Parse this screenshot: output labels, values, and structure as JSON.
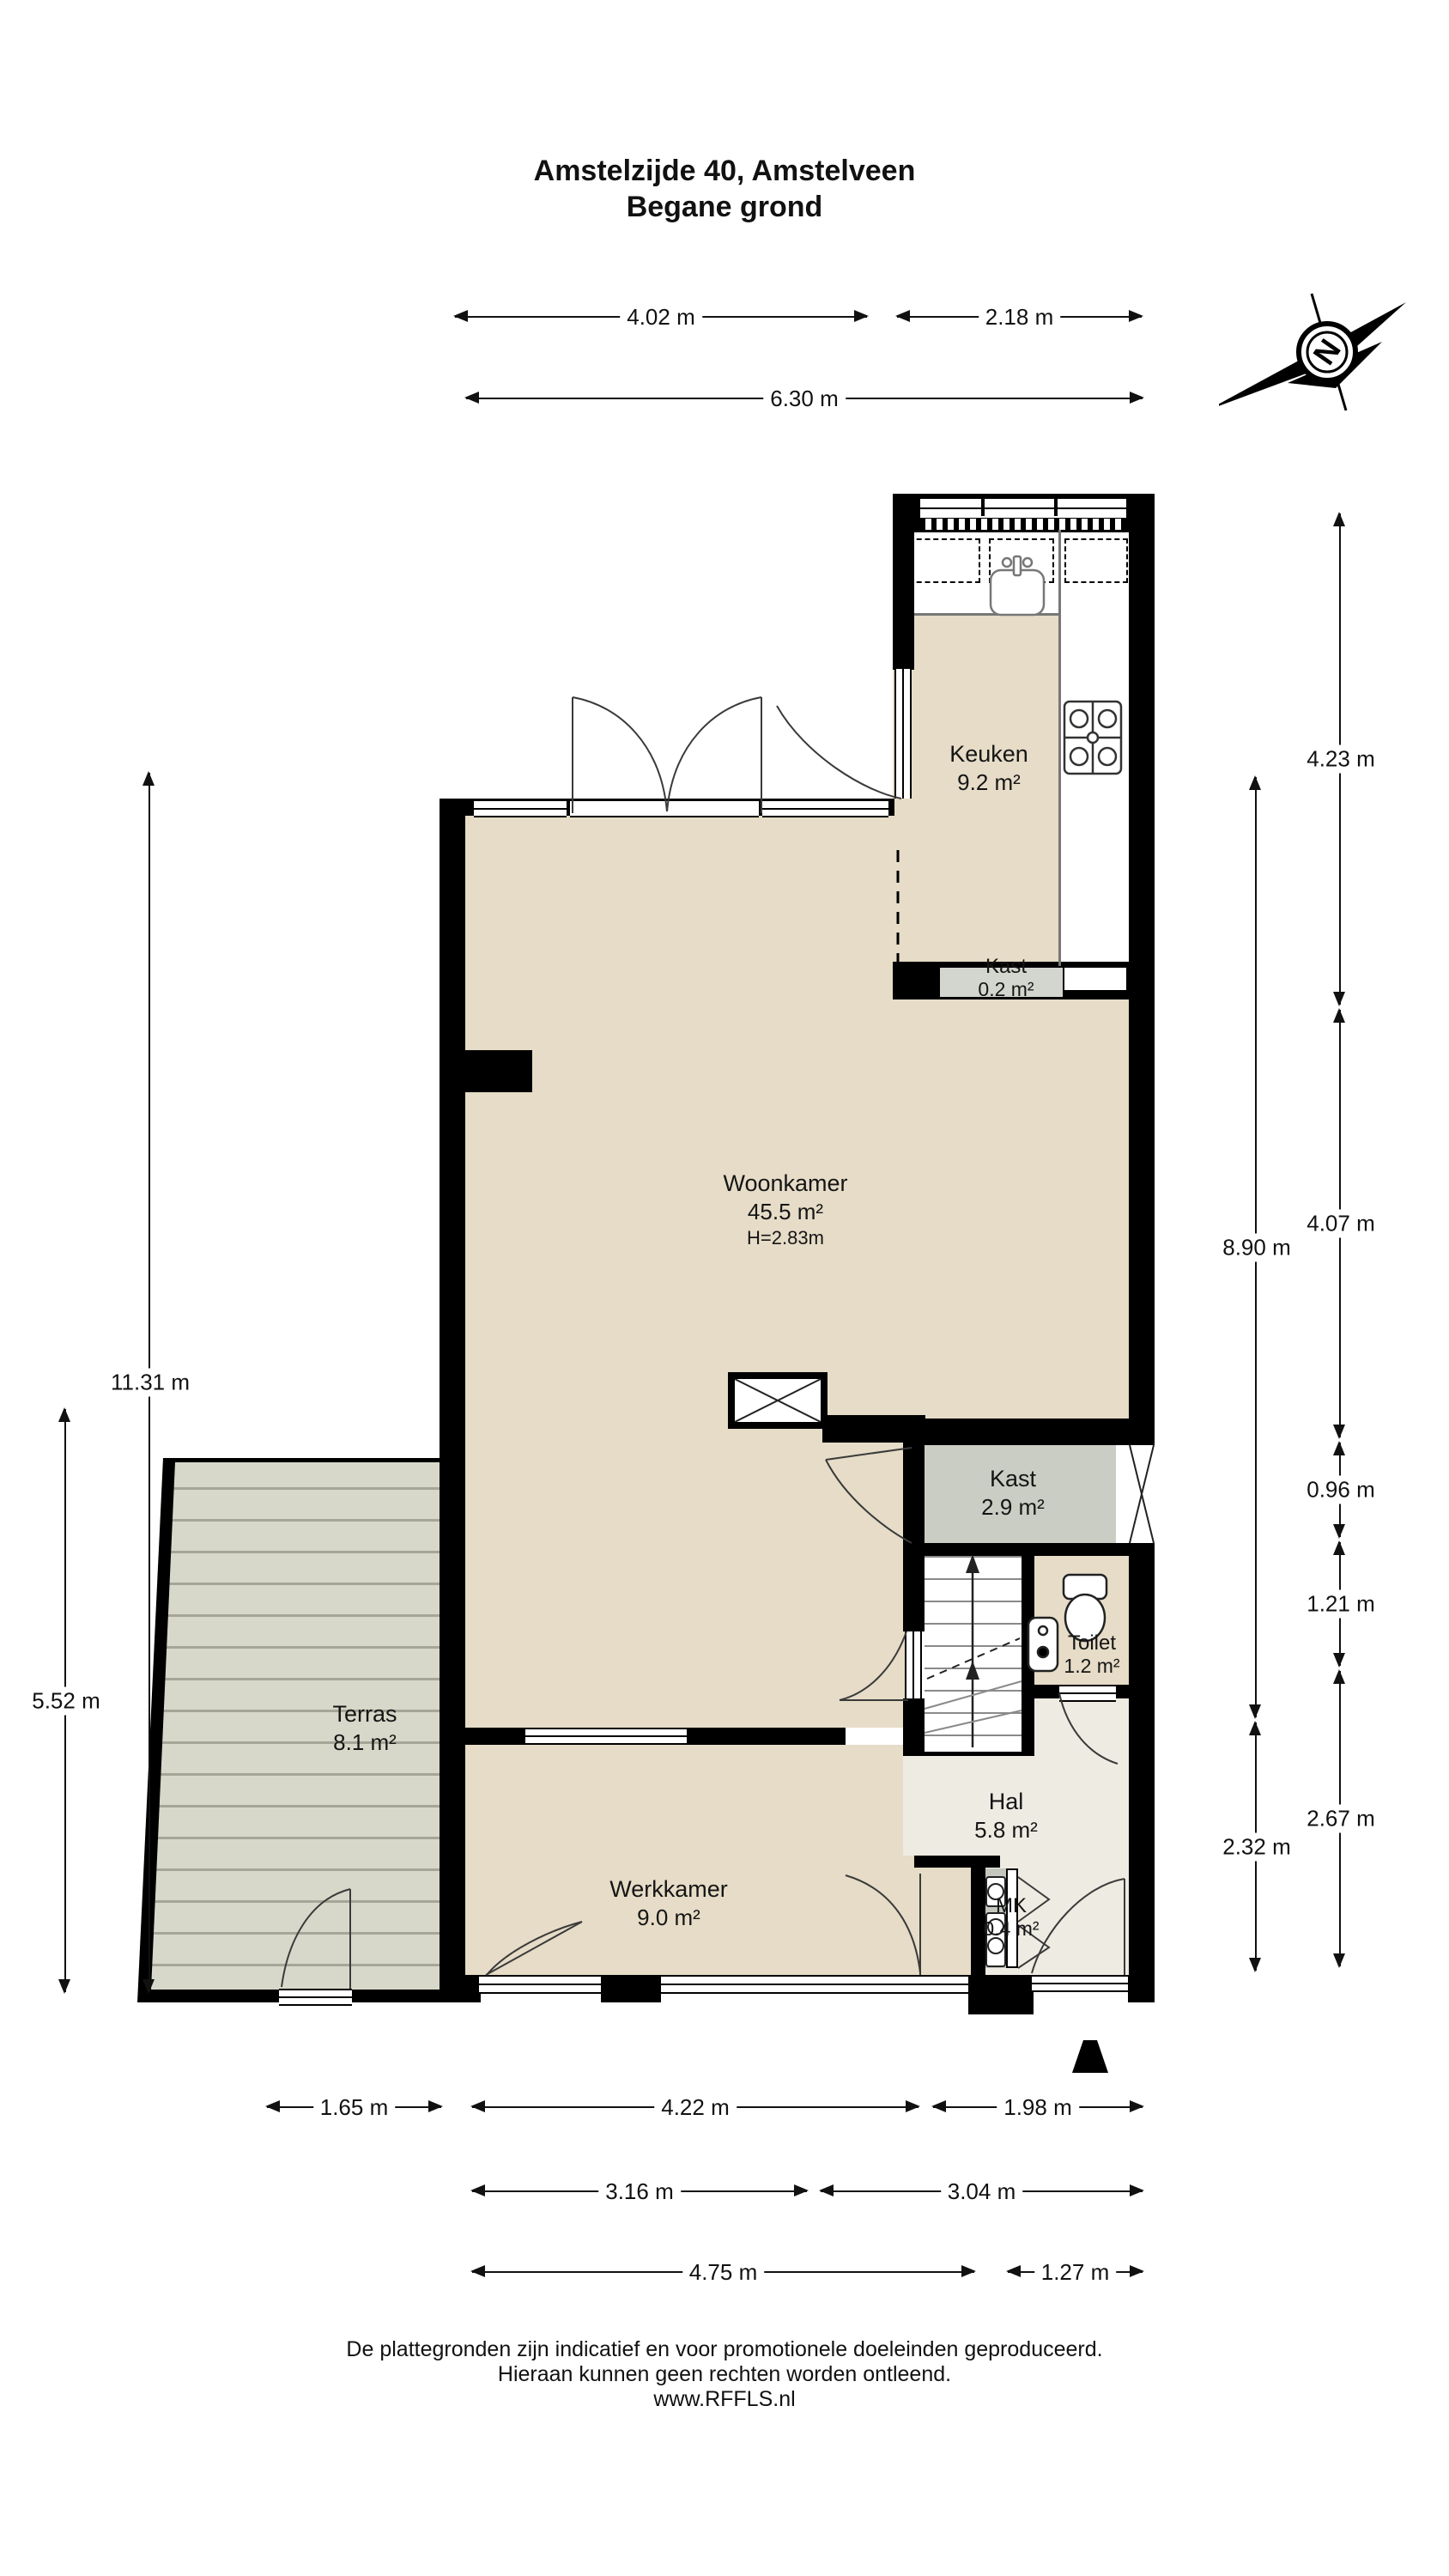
{
  "title": {
    "line1": "Amstelzijde 40, Amstelveen",
    "line2": "Begane grond"
  },
  "compass": {
    "letter": "N"
  },
  "rooms": {
    "keuken": {
      "name": "Keuken",
      "area": "9.2 m²"
    },
    "kast_klein": {
      "name": "Kast",
      "area": "0.2 m²"
    },
    "woonkamer": {
      "name": "Woonkamer",
      "area": "45.5 m²",
      "height": "H=2.83m"
    },
    "kast": {
      "name": "Kast",
      "area": "2.9 m²"
    },
    "toilet": {
      "name": "Toilet",
      "area": "1.2 m²"
    },
    "hal": {
      "name": "Hal",
      "area": "5.8 m²"
    },
    "mk": {
      "name": "MK",
      "area": "0.4 m²"
    },
    "werkkamer": {
      "name": "Werkkamer",
      "area": "9.0 m²"
    },
    "terras": {
      "name": "Terras",
      "area": "8.1 m²"
    }
  },
  "dimensions": {
    "top": [
      {
        "label": "4.02 m"
      },
      {
        "label": "2.18 m"
      },
      {
        "label": "6.30 m"
      }
    ],
    "left": [
      {
        "label": "11.31 m"
      },
      {
        "label": "5.52 m"
      }
    ],
    "right": [
      {
        "label": "8.90 m"
      },
      {
        "label": "2.32 m"
      },
      {
        "label": "4.23 m"
      },
      {
        "label": "4.07 m"
      },
      {
        "label": "0.96 m"
      },
      {
        "label": "1.21 m"
      },
      {
        "label": "2.67 m"
      }
    ],
    "bottom": [
      {
        "label": "1.65 m"
      },
      {
        "label": "4.22 m"
      },
      {
        "label": "1.98 m"
      },
      {
        "label": "3.16 m"
      },
      {
        "label": "3.04 m"
      },
      {
        "label": "4.75 m"
      },
      {
        "label": "1.27 m"
      }
    ]
  },
  "footer": {
    "line1": "De plattegronden zijn indicatief en voor promotionele doeleinden geproduceerd.",
    "line2": "Hieraan kunnen geen rechten worden ontleend.",
    "line3": "www.RFFLS.nl"
  },
  "colors": {
    "floor": "#e6dcc7",
    "hall_floor": "#eeebe2",
    "closet": "#cacdc3",
    "closet_small": "#d3d6cf",
    "meter_closet": "#c3c7bd",
    "terrace": "#d8d8ca",
    "wall": "#000000"
  }
}
